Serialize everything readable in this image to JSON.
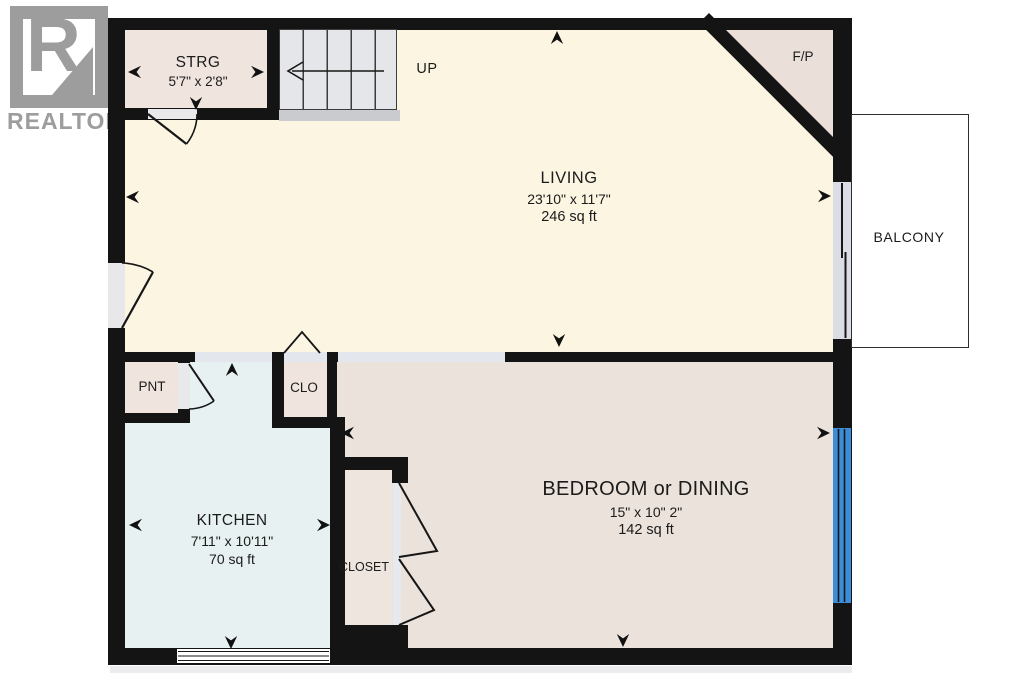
{
  "logo": {
    "wordmark": "REALTOR",
    "registered": "®"
  },
  "stairs": {
    "direction_label": "UP"
  },
  "rooms": {
    "storage": {
      "name": "STRG",
      "dims": "5'7\" x 2'8\""
    },
    "living": {
      "name": "LIVING",
      "dims": "23'10\" x 11'7\"",
      "area": "246 sq ft"
    },
    "fireplace": {
      "name": "F/P"
    },
    "balcony": {
      "name": "BALCONY"
    },
    "pantry": {
      "name": "PNT"
    },
    "hall_closet": {
      "name": "CLO"
    },
    "kitchen": {
      "name": "KITCHEN",
      "dims": "7'11\" x 10'11\"",
      "area": "70 sq ft"
    },
    "bedroom_closet": {
      "name": "CLOSET"
    },
    "bedroom": {
      "name": "BEDROOM or DINING",
      "dims": "15\" x 10\" 2\"",
      "area": "142 sq ft"
    }
  },
  "colors": {
    "wall": "#141414",
    "living_floor": "#fbf5e2",
    "bedroom_floor": "#ebe2db",
    "closet_floor": "#efe5de",
    "kitchen_floor": "#e8f1f1",
    "stairs_fill": "#e4e6ea",
    "opening_fill": "#e3e6ec",
    "window_blue": "#3d8cd8",
    "balcony_fill": "#ffffff",
    "logo_gray": "#9d9d9d"
  }
}
